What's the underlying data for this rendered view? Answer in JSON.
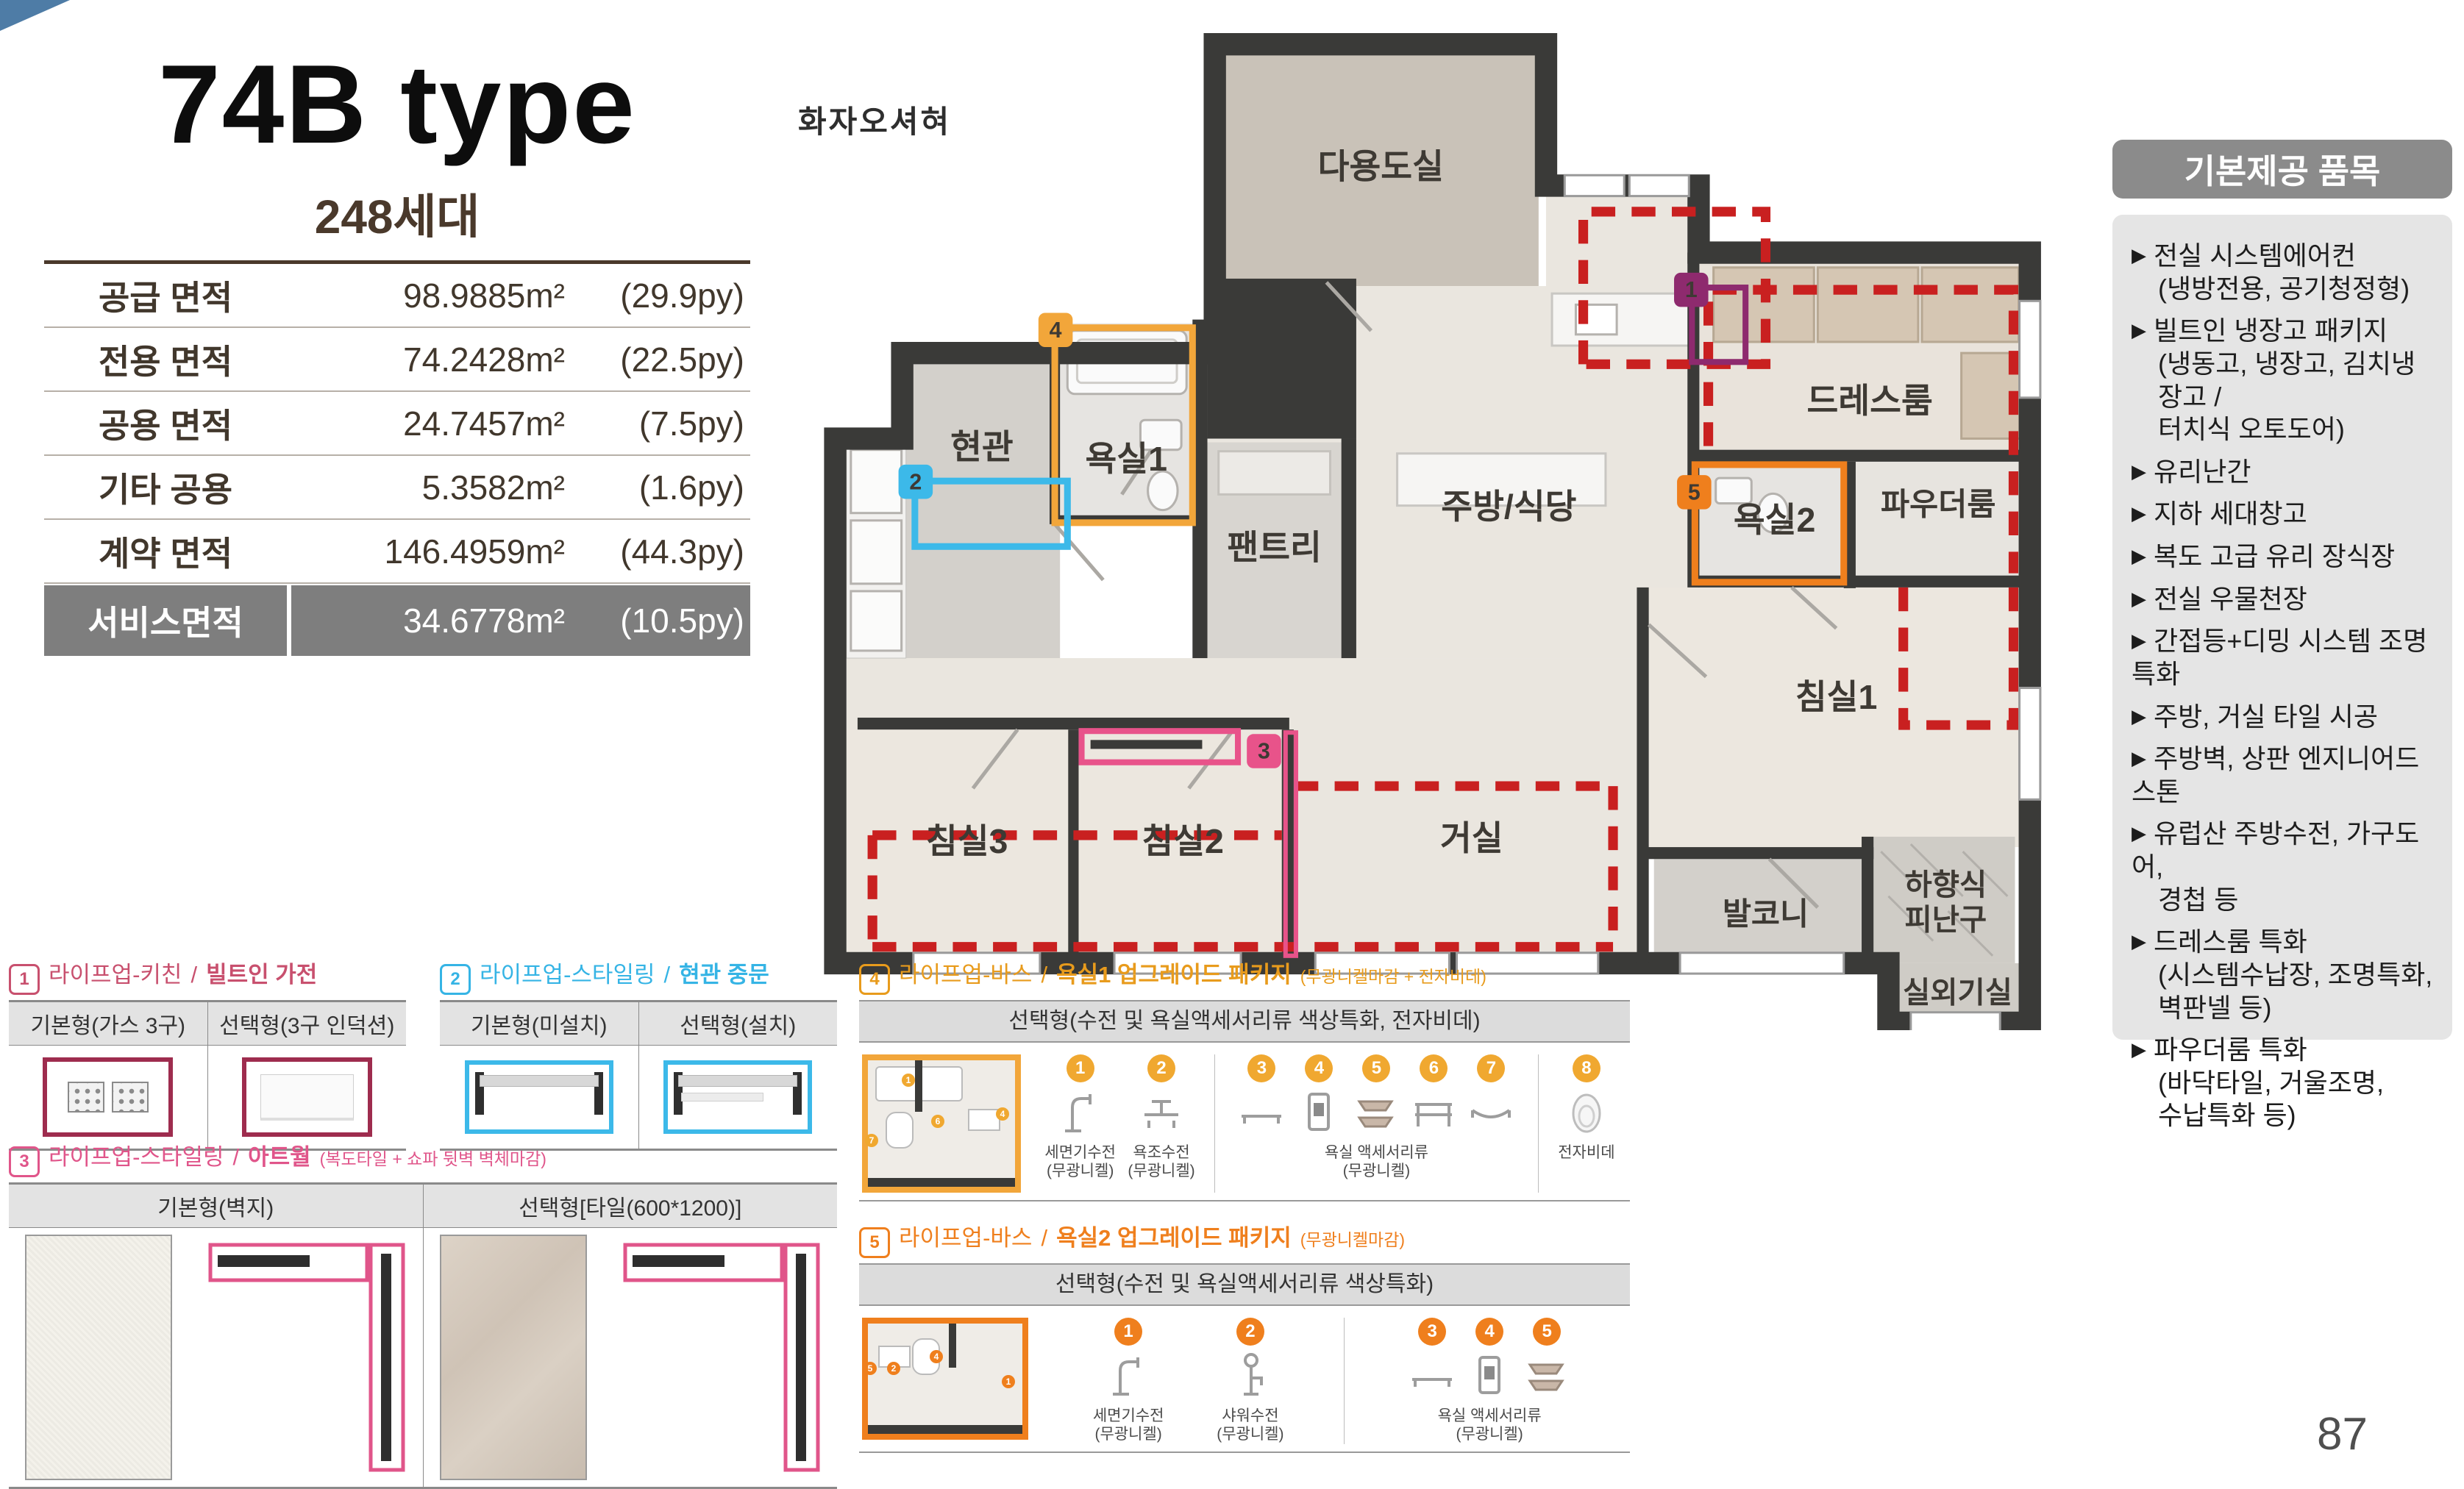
{
  "page": {
    "number": "87",
    "watermark": "화자오셔혀"
  },
  "header": {
    "title": "74B type",
    "units": "248세대"
  },
  "colors": {
    "badge1_purple": "#8e2a6e",
    "badge2_cyan": "#3cb9e9",
    "badge3_pink": "#e8538a",
    "badge4_amber": "#f2a63a",
    "badge5_orange": "#ef7f1d",
    "red_dash": "#c92020",
    "table_highlight": "#7e7e7e",
    "sidebar_header_bg": "#8b8b8b"
  },
  "area_table": {
    "rows": [
      {
        "label": "공급 면적",
        "m2": "98.9885m²",
        "py": "(29.9py)"
      },
      {
        "label": "전용 면적",
        "m2": "74.2428m²",
        "py": "(22.5py)"
      },
      {
        "label": "공용 면적",
        "m2": "24.7457m²",
        "py": "(7.5py)"
      },
      {
        "label": "기타 공용",
        "m2": "5.3582m²",
        "py": "(1.6py)"
      },
      {
        "label": "계약 면적",
        "m2": "146.4959m²",
        "py": "(44.3py)"
      }
    ],
    "service": {
      "label": "서비스면적",
      "m2": "34.6778m²",
      "py": "(10.5py)"
    }
  },
  "floor_plan": {
    "rooms": {
      "utility": "다용도실",
      "entrance": "현관",
      "bath1": "욕실1",
      "pantry": "팬트리",
      "kitchen": "주방/식당",
      "dressroom": "드레스룸",
      "powder": "파우더룸",
      "bath2": "욕실2",
      "bed1": "침실1",
      "bed2": "침실2",
      "bed3": "침실3",
      "living": "거실",
      "balcony": "발코니",
      "escape1": "하향식",
      "escape2": "피난구",
      "outdoor": "실외기실"
    },
    "badges": {
      "b1": "1",
      "b2": "2",
      "b3": "3",
      "b4": "4",
      "b5": "5"
    }
  },
  "sidebar": {
    "header": "기본제공 품목",
    "bullet": "▶",
    "items": [
      {
        "lines": [
          "전실 시스템에어컨",
          "(냉방전용, 공기청정형)"
        ]
      },
      {
        "lines": [
          "빌트인 냉장고 패키지",
          "(냉동고, 냉장고, 김치냉장고 /",
          "터치식 오토도어)"
        ]
      },
      {
        "lines": [
          "유리난간"
        ]
      },
      {
        "lines": [
          "지하 세대창고"
        ]
      },
      {
        "lines": [
          "복도 고급 유리 장식장"
        ]
      },
      {
        "lines": [
          "전실 우물천장"
        ]
      },
      {
        "lines": [
          "간접등+디밍 시스템 조명특화"
        ]
      },
      {
        "lines": [
          "주방, 거실 타일 시공"
        ]
      },
      {
        "lines": [
          "주방벽, 상판 엔지니어드 스톤"
        ]
      },
      {
        "lines": [
          "유럽산 주방수전, 가구도어,",
          "경첩 등"
        ]
      },
      {
        "lines": [
          "드레스룸 특화",
          "(시스템수납장, 조명특화,",
          "벽판넬 등)"
        ]
      },
      {
        "lines": [
          "파우더룸 특화",
          "(바닥타일, 거울조명,",
          "수납특화 등)"
        ]
      }
    ]
  },
  "options": {
    "sep": "/",
    "s1": {
      "num": "1",
      "category": "라이프업-키친",
      "name": "빌트인 가전",
      "col1": "기본형(가스 3구)",
      "col2": "선택형(3구 인덕션)"
    },
    "s2": {
      "num": "2",
      "category": "라이프업-스타일링",
      "name": "현관 중문",
      "col1": "기본형(미설치)",
      "col2": "선택형(설치)"
    },
    "s3": {
      "num": "3",
      "category": "라이프업-스타일링",
      "name": "아트월",
      "note": "(복도타일 + 쇼파 뒷벽 벽체마감)",
      "col1": "기본형(벽지)",
      "col2": "선택형[타일(600*1200)]"
    },
    "s4": {
      "num": "4",
      "category": "라이프업-바스",
      "name": "욕실1 업그레이드 패키지",
      "note": "(무광니켈마감 + 전자비데)",
      "bar": "선택형(수전 및 욕실액세서리류 색상특화, 전자비데)",
      "nums": [
        "1",
        "2",
        "3",
        "4",
        "5",
        "6",
        "7",
        "8"
      ],
      "item1": "세면기수전",
      "item1b": "(무광니켈)",
      "item2": "욕조수전",
      "item2b": "(무광니켈)",
      "acc": "욕실 액세서리류",
      "accb": "(무광니켈)",
      "bidet": "전자비데"
    },
    "s5": {
      "num": "5",
      "category": "라이프업-바스",
      "name": "욕실2 업그레이드 패키지",
      "note": "(무광니켈마감)",
      "bar": "선택형(수전 및 욕실액세서리류 색상특화)",
      "nums": [
        "1",
        "2",
        "3",
        "4",
        "5"
      ],
      "item1": "세면기수전",
      "item1b": "(무광니켈)",
      "item2": "샤워수전",
      "item2b": "(무광니켈)",
      "acc": "욕실 액세서리류",
      "accb": "(무광니켈)"
    }
  }
}
